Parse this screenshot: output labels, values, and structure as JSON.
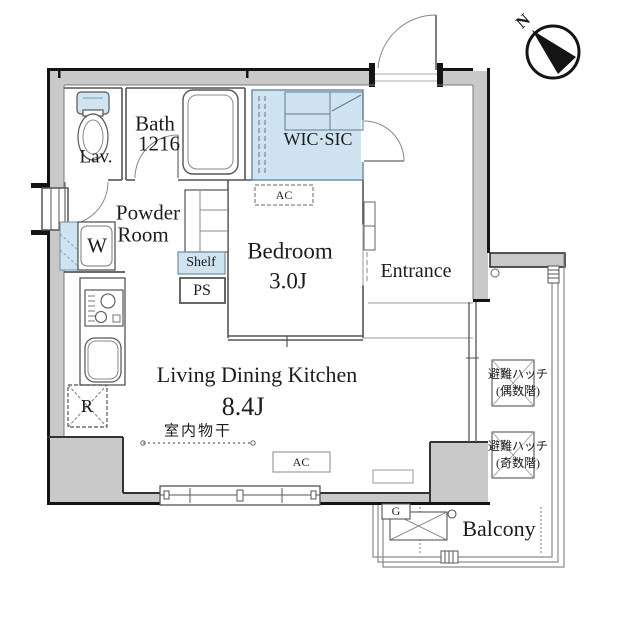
{
  "compass": {
    "north": "N"
  },
  "rooms": {
    "lav": "Lav.",
    "bath_line1": "Bath",
    "bath_line2": "1216",
    "powder_line1": "Powder",
    "powder_line2": "Room",
    "wic": "WIC·SIC",
    "bedroom": "Bedroom",
    "bedroom_size": "3.0J",
    "entrance": "Entrance",
    "ldk": "Living Dining Kitchen",
    "ldk_size": "8.4J",
    "balcony": "Balcony"
  },
  "labels": {
    "washer": "W",
    "shelf": "Shelf",
    "pipe_shaft": "PS",
    "ac_bedroom": "AC",
    "ac_ldk": "AC",
    "refrigerator": "R",
    "gas_heater": "G",
    "indoor_drying": "室内物干",
    "hatch_even_line1": "避難ハッチ",
    "hatch_even_line2": "(偶数階)",
    "hatch_odd_line1": "避難ハッチ",
    "hatch_odd_line2": "(奇数階)"
  },
  "colors": {
    "wall_fill": "#c9c9c9",
    "closet_fill": "#cfe3f1",
    "outline": "#141414",
    "thin_line": "#5a5a5a"
  }
}
